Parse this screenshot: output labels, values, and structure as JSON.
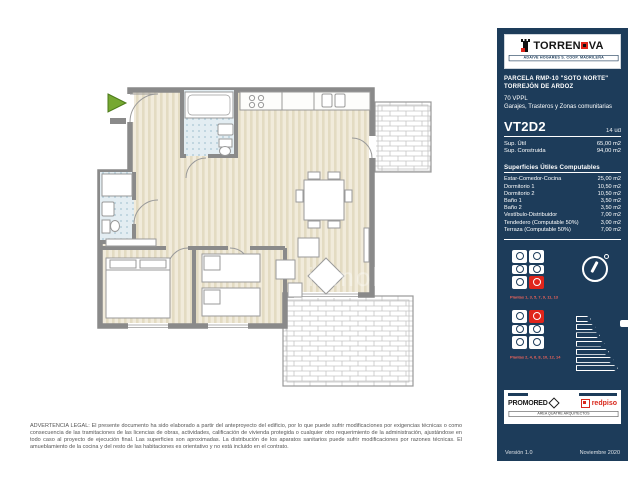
{
  "colors": {
    "panel": "#1d3c5a",
    "accent_red": "#e0251b",
    "caption_red": "#f0645a",
    "wall_gray": "#8a8a8a"
  },
  "header": {
    "brand_prefix": "TORREN",
    "brand_suffix": "VA",
    "tagline": "ADAIVE HOGARES S. COOP. MADRILEÑA"
  },
  "project": {
    "line1": "PARCELA RMP-10 \"SOTO NORTE\"",
    "line2": "TORREJÓN DE ARDOZ",
    "line3": "70 VPPL",
    "line4": "Garajes, Trasteros y Zonas comunitarias"
  },
  "unit": {
    "model": "VT2D2",
    "count": "14 ud",
    "summary": [
      {
        "label": "Sup. Útil",
        "value": "65,00 m2"
      },
      {
        "label": "Sup. Construida",
        "value": "94,00 m2"
      }
    ]
  },
  "surfaces": {
    "title": "Superficies Útiles Computables",
    "rows": [
      {
        "label": "Estar-Comedor-Cocina",
        "value": "25,00 m2"
      },
      {
        "label": "Dormitorio 1",
        "value": "10,50 m2"
      },
      {
        "label": "Dormitorio 2",
        "value": "10,50 m2"
      },
      {
        "label": "Baño 1",
        "value": "3,50 m2"
      },
      {
        "label": "Baño 2",
        "value": "3,50 m2"
      },
      {
        "label": "Vestíbulo-Distribuidor",
        "value": "7,00 m2"
      },
      {
        "label": "Tendedero (Computable 50%)",
        "value": "3,00 m2"
      },
      {
        "label": "Terraza (Computable 50%)",
        "value": "7,00 m2"
      }
    ]
  },
  "keyplans": [
    {
      "caption": "Plantas 1, 3, 5, 7, 9, 11, 13",
      "highlight_index": 5
    },
    {
      "caption": "Plantas 2, 4, 6, 8, 10, 12, 14",
      "highlight_index": 1
    }
  ],
  "footer": {
    "developer": "PROMORED",
    "agency": "redpiso",
    "architect": "AREA QUATRE ARQUITECTOS",
    "version": "Versión 1.0",
    "date": "Noviembre 2020"
  },
  "watermark": "inmob",
  "disclaimer": "ADVERTENCIA LEGAL: El presente documento ha sido elaborado a partir del anteproyecto del edificio, por lo que puede sufrir modificaciones por exigencias técnicas o como consecuencia de las tramitaciones de las licencias de obras, actividades, calificación de vivienda protegida o cualquier otro requerimiento de la administración, ajustándose en todo caso al proyecto de ejecución final. Las superficies son aproximadas. La distribución de los aparatos sanitarios puede sufrir modificaciones por razones técnicas. El amueblamiento de la cocina y del resto de las habitaciones es orientativo y no está incluido en el contrato."
}
